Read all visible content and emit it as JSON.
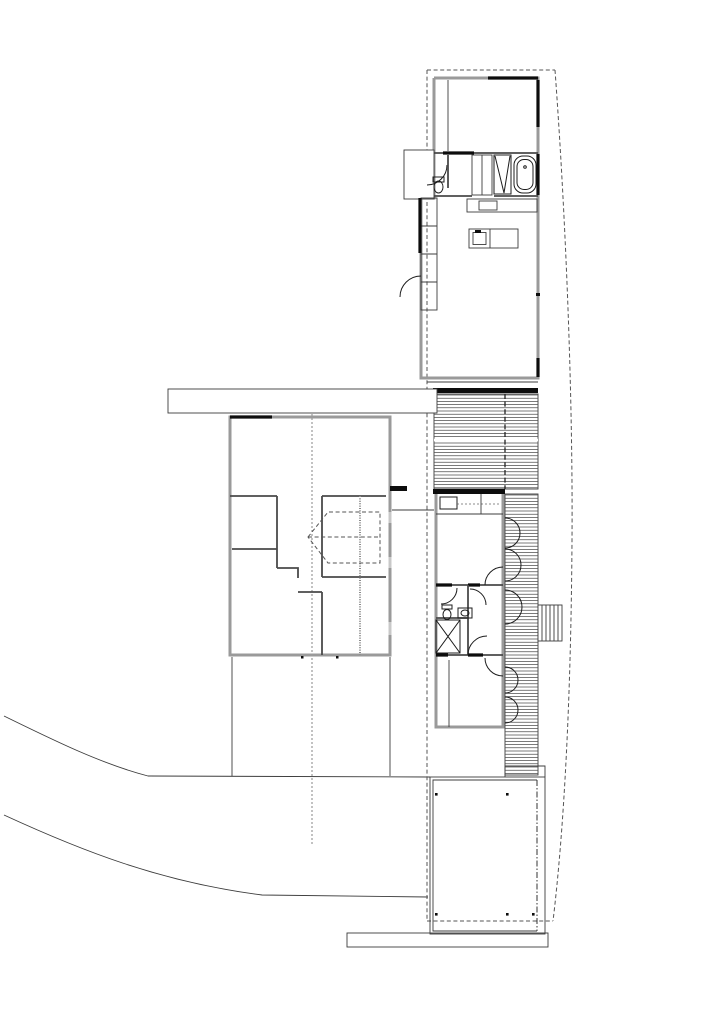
{
  "canvas": {
    "width": 724,
    "height": 1024,
    "viewBox": "0 0 724 1024",
    "background": "#ffffff"
  },
  "palette": {
    "ink": "#0d0d0d",
    "wall_gray": "#9a9a9a",
    "hatch_gray": "#4f4f4f",
    "dash_gray": "#555555",
    "background": "#ffffff"
  },
  "groups": [
    {
      "name": "site",
      "items": [
        {
          "tag": "path",
          "cls": "thin",
          "name": "ground-path-upper",
          "d": "M 4,716 C 55,741 102,764 148,776 L 430,777"
        },
        {
          "tag": "path",
          "cls": "thin",
          "name": "ground-path-lower",
          "d": "M 4,815 C 80,850 160,882 262,895 L 428,897"
        },
        {
          "tag": "line",
          "cls": "thin",
          "name": "courtyard-edge-west",
          "x1": 232,
          "y1": 657,
          "x2": 232,
          "y2": 776
        },
        {
          "tag": "line",
          "cls": "thin",
          "name": "courtyard-edge-east",
          "x1": 390,
          "y1": 657,
          "x2": 390,
          "y2": 776
        },
        {
          "tag": "line",
          "cls": "dashf",
          "name": "center-line",
          "x1": 312,
          "y1": 390,
          "x2": 312,
          "y2": 846
        }
      ]
    },
    {
      "name": "roof-outline",
      "items": [
        {
          "tag": "line",
          "cls": "dash",
          "name": "roof-edge-west",
          "x1": 427,
          "y1": 70,
          "x2": 427,
          "y2": 921
        },
        {
          "tag": "line",
          "cls": "dash",
          "name": "roof-edge-north",
          "x1": 427,
          "y1": 70,
          "x2": 555,
          "y2": 70
        },
        {
          "tag": "path",
          "cls": "dash",
          "name": "roof-edge-east-curved",
          "d": "M 555,70 C 566,220 573,400 572,540 C 571,700 564,830 553,921"
        },
        {
          "tag": "line",
          "cls": "dash",
          "name": "roof-edge-south",
          "x1": 427,
          "y1": 921,
          "x2": 553,
          "y2": 921
        }
      ]
    },
    {
      "name": "upper-pavilion",
      "items": [
        {
          "tag": "path",
          "cls": "wall",
          "name": "wall-outline-upper",
          "d": "M 434,78 L 538,78 L 538,378 L 421,378 L 421,198 L 434,198 L 434,78"
        },
        {
          "tag": "line",
          "cls": "wallD",
          "name": "wall-bedroom-bath",
          "x1": 434,
          "y1": 153,
          "x2": 538,
          "y2": 153
        },
        {
          "tag": "line",
          "cls": "solid",
          "name": "solid-wall-bedroom-bath",
          "x1": 443,
          "y1": 153,
          "x2": 474,
          "y2": 153
        },
        {
          "tag": "path",
          "cls": "wallD",
          "name": "wall-bath-south",
          "d": "M 434,196 L 472,196 M 494,196 L 538,196"
        },
        {
          "tag": "line",
          "cls": "solid",
          "name": "solid-wall-north",
          "x1": 488,
          "y1": 78,
          "x2": 538,
          "y2": 78
        },
        {
          "tag": "path",
          "cls": "solid",
          "name": "solid-wall-east",
          "d": "M 538,80 L 538,127 M 538,154 L 538,195 M 538,358 L 538,377"
        },
        {
          "tag": "line",
          "cls": "thin",
          "name": "bedroom-closet-divider",
          "x1": 448,
          "y1": 80,
          "x2": 448,
          "y2": 151
        },
        {
          "tag": "rect",
          "cls": "thinw",
          "name": "entry-porch",
          "x": 404,
          "y": 150,
          "w": 30,
          "h": 49
        },
        {
          "tag": "path",
          "cls": "fix",
          "name": "entry-door-arc",
          "d": "M 447,165 A 20 20 0 0 1 427,185"
        },
        {
          "tag": "line",
          "cls": "wallD",
          "name": "wc-wall",
          "x1": 448,
          "y1": 155,
          "x2": 448,
          "y2": 188
        },
        {
          "tag": "rect",
          "cls": "fix",
          "name": "toilet-tank-upper",
          "x": 433,
          "y": 177,
          "w": 11,
          "h": 5
        },
        {
          "tag": "ellipse",
          "cls": "fix",
          "name": "toilet-upper",
          "cx": 438.5,
          "cy": 187,
          "rx": 4.5,
          "ry": 6
        },
        {
          "tag": "rect",
          "cls": "thin",
          "name": "bath-closet",
          "x": 472,
          "y": 155,
          "w": 20,
          "h": 40
        },
        {
          "tag": "line",
          "cls": "thin",
          "name": "bath-closet-divider",
          "x1": 482,
          "y1": 155,
          "x2": 482,
          "y2": 195
        },
        {
          "tag": "rect",
          "cls": "fix",
          "name": "shower-upper",
          "x": 494,
          "y": 155,
          "w": 17,
          "h": 39
        },
        {
          "tag": "path",
          "cls": "fix",
          "name": "shower-upper-glass",
          "d": "M 495,156 L 504,193 L 510,156"
        },
        {
          "tag": "rect",
          "cls": "fix",
          "name": "bathtub-outer",
          "x": 514,
          "y": 156,
          "w": 22,
          "h": 37,
          "rx": 9
        },
        {
          "tag": "rect",
          "cls": "fix",
          "name": "bathtub-inner",
          "x": 517,
          "y": 159.5,
          "w": 16,
          "h": 30,
          "rx": 7
        },
        {
          "tag": "circle",
          "cls": "fix",
          "name": "bathtub-drain",
          "cx": 525,
          "cy": 167,
          "r": 1.3
        },
        {
          "tag": "rect",
          "cls": "thin",
          "name": "kitchen-counter",
          "x": 467,
          "y": 199,
          "w": 70,
          "h": 13
        },
        {
          "tag": "rect",
          "cls": "thin",
          "name": "counter-sink",
          "x": 479,
          "y": 201,
          "w": 18,
          "h": 9
        },
        {
          "tag": "rect",
          "cls": "thin",
          "name": "west-closet",
          "x": 421,
          "y": 198,
          "w": 16,
          "h": 112
        },
        {
          "tag": "path",
          "cls": "thin",
          "name": "west-closet-dividers",
          "d": "M 421,226 L 437,226 M 421,254 L 437,254 M 421,282 L 437,282"
        },
        {
          "tag": "line",
          "cls": "solid",
          "name": "solid-wall-west",
          "x1": 420,
          "y1": 198,
          "x2": 420,
          "y2": 253
        },
        {
          "tag": "path",
          "cls": "fix",
          "name": "west-door-arc",
          "d": "M 400,297 A 21 21 0 0 1 421,276"
        },
        {
          "tag": "rect",
          "cls": "thin",
          "name": "kitchen-island",
          "x": 469,
          "y": 229,
          "w": 49,
          "h": 19
        },
        {
          "tag": "rect",
          "cls": "thin",
          "name": "island-sink",
          "x": 473,
          "y": 232.5,
          "w": 13,
          "h": 12
        },
        {
          "tag": "rect",
          "cls": "fill",
          "name": "island-faucet",
          "x": 475,
          "y": 230,
          "w": 6,
          "h": 3
        },
        {
          "tag": "line",
          "cls": "thin",
          "name": "island-divider",
          "x1": 490,
          "y1": 229,
          "x2": 490,
          "y2": 248
        },
        {
          "tag": "line",
          "cls": "thin",
          "name": "south-step-edge",
          "x1": 427,
          "y1": 382,
          "x2": 538,
          "y2": 382
        },
        {
          "tag": "rect",
          "cls": "fill",
          "name": "threshold-bar",
          "x": 433,
          "y": 388,
          "w": 105,
          "h": 5
        },
        {
          "tag": "rect",
          "cls": "fill",
          "name": "window-tick-east",
          "x": 536,
          "y": 293,
          "w": 4,
          "h": 3
        }
      ]
    },
    {
      "name": "deck",
      "items": [
        {
          "tag": "rect",
          "cls": "thin",
          "name": "deck-upper-outline",
          "x": 434,
          "y": 394,
          "w": 104,
          "h": 95
        },
        {
          "tag": "hatch",
          "cls": "hatch",
          "name": "deck-upper-boards",
          "x": 434,
          "y": 394,
          "w": 104,
          "h": 95,
          "step": 3.2
        },
        {
          "tag": "line",
          "cls": "gap",
          "name": "deck-joint",
          "x1": 434,
          "y1": 440,
          "x2": 538,
          "y2": 440
        },
        {
          "tag": "line",
          "cls": "dashw",
          "name": "deck-axis-line",
          "x1": 505,
          "y1": 394,
          "x2": 505,
          "y2": 489
        },
        {
          "tag": "rect",
          "cls": "thin",
          "name": "deck-side-outline",
          "x": 505,
          "y": 494,
          "w": 33,
          "h": 281
        },
        {
          "tag": "hatch",
          "cls": "hatch",
          "name": "deck-side-boards",
          "x": 505,
          "y": 494,
          "w": 33,
          "h": 281,
          "step": 3.2
        },
        {
          "tag": "rect",
          "cls": "thinw",
          "name": "deck-stairs",
          "x": 538,
          "y": 605,
          "w": 24,
          "h": 36
        },
        {
          "tag": "path",
          "cls": "thin",
          "name": "stair-treads",
          "d": "M 542,605 L 542,641 M 546,605 L 546,641 M 550,605 L 550,641 M 554,605 L 554,641 M 558,605 L 558,641"
        },
        {
          "tag": "path",
          "cls": "fix",
          "name": "deck-door-arc-1",
          "d": "M 505,518 A 15 15 0 0 1 505,548"
        },
        {
          "tag": "path",
          "cls": "fix",
          "name": "deck-door-arc-2",
          "d": "M 505,549 A 16 16 0 0 1 505,581"
        },
        {
          "tag": "path",
          "cls": "fix",
          "name": "deck-door-arc-3",
          "d": "M 505,590 A 17 17 0 0 1 505,624"
        },
        {
          "tag": "path",
          "cls": "fix",
          "name": "deck-door-arc-4",
          "d": "M 505,667 A 13 13 0 0 1 505,693"
        },
        {
          "tag": "path",
          "cls": "fix",
          "name": "deck-door-arc-5",
          "d": "M 505,697 A 13 13 0 0 1 505,723"
        }
      ]
    },
    {
      "name": "middle-pavilion",
      "items": [
        {
          "tag": "rect",
          "cls": "wall",
          "name": "wall-outline-middle",
          "x": 436,
          "y": 492,
          "w": 67,
          "h": 235
        },
        {
          "tag": "rect",
          "cls": "fill",
          "name": "threshold-middle",
          "x": 433,
          "y": 489,
          "w": 72,
          "h": 5
        },
        {
          "tag": "line",
          "cls": "thin",
          "name": "kitchenette-counter",
          "x1": 436,
          "y1": 514,
          "x2": 503,
          "y2": 514
        },
        {
          "tag": "rect",
          "cls": "fix",
          "name": "kitchenette-appliance",
          "x": 440,
          "y": 497,
          "w": 17,
          "h": 12
        },
        {
          "tag": "line",
          "cls": "dashf",
          "name": "kitchenette-dash",
          "x1": 457,
          "y1": 504,
          "x2": 500,
          "y2": 504
        },
        {
          "tag": "line",
          "cls": "thin",
          "name": "kitchenette-divider",
          "x1": 481,
          "y1": 494,
          "x2": 481,
          "y2": 514
        },
        {
          "tag": "line",
          "cls": "wallD",
          "name": "wall-bed1-south",
          "x1": 436,
          "y1": 585,
          "x2": 503,
          "y2": 585
        },
        {
          "tag": "path",
          "cls": "solid",
          "name": "solid-bed1-south",
          "d": "M 436,585 L 452,585 M 468,585 L 480,585"
        },
        {
          "tag": "path",
          "cls": "fix",
          "name": "bed1-door-arc",
          "d": "M 485,585 A 18 18 0 0 1 503,567"
        },
        {
          "tag": "line",
          "cls": "wallD",
          "name": "hall-wall-west",
          "x1": 468,
          "y1": 585,
          "x2": 468,
          "y2": 655
        },
        {
          "tag": "line",
          "cls": "wallD",
          "name": "wc2-wall-south",
          "x1": 436,
          "y1": 618,
          "x2": 468,
          "y2": 618
        },
        {
          "tag": "line",
          "cls": "wallD",
          "name": "wall-bed2-north",
          "x1": 436,
          "y1": 655,
          "x2": 503,
          "y2": 655
        },
        {
          "tag": "path",
          "cls": "solid",
          "name": "solid-bed2-north",
          "d": "M 436,655 L 448,655 M 468,655 L 483,655"
        },
        {
          "tag": "path",
          "cls": "fix",
          "name": "wc2-door-arc",
          "d": "M 457,588 A 16 16 0 0 1 441,604"
        },
        {
          "tag": "rect",
          "cls": "fix",
          "name": "toilet-tank-mid",
          "x": 442,
          "y": 605,
          "w": 10,
          "h": 4
        },
        {
          "tag": "ellipse",
          "cls": "fix",
          "name": "toilet-mid",
          "cx": 447,
          "cy": 614.5,
          "rx": 4,
          "ry": 5
        },
        {
          "tag": "rect",
          "cls": "fix",
          "name": "sink-mid",
          "x": 458,
          "y": 608,
          "w": 14,
          "h": 10
        },
        {
          "tag": "ellipse",
          "cls": "fix",
          "name": "sink-basin-mid",
          "cx": 465,
          "cy": 613,
          "rx": 4,
          "ry": 3
        },
        {
          "tag": "rect",
          "cls": "fix",
          "name": "shower-mid",
          "x": 436,
          "y": 620,
          "w": 24,
          "h": 33
        },
        {
          "tag": "path",
          "cls": "fix",
          "name": "shower-mid-x",
          "d": "M 436,620 L 460,653 M 460,620 L 436,653"
        },
        {
          "tag": "path",
          "cls": "fix",
          "name": "hall-door-arc-a",
          "d": "M 470,589 A 16 16 0 0 1 486,605"
        },
        {
          "tag": "path",
          "cls": "fix",
          "name": "hall-door-arc-b",
          "d": "M 468,655 A 19 19 0 0 1 487,636"
        },
        {
          "tag": "path",
          "cls": "fix",
          "name": "bed2-door-arc",
          "d": "M 503,676 A 18 18 0 0 1 485,658"
        },
        {
          "tag": "line",
          "cls": "thin",
          "name": "bed2-closet-divider",
          "x1": 449,
          "y1": 660,
          "x2": 449,
          "y2": 727
        },
        {
          "tag": "line",
          "cls": "thin",
          "name": "link-line",
          "x1": 392,
          "y1": 510,
          "x2": 434,
          "y2": 510
        }
      ]
    },
    {
      "name": "left-wing",
      "items": [
        {
          "tag": "rect",
          "cls": "thinw",
          "name": "walkway-band",
          "x": 168,
          "y": 389,
          "w": 269,
          "h": 24
        },
        {
          "tag": "rect",
          "cls": "wall",
          "name": "wall-outline-left",
          "x": 230,
          "y": 417,
          "w": 160,
          "h": 238
        },
        {
          "tag": "line",
          "cls": "solid",
          "name": "solid-left-north",
          "x1": 230,
          "y1": 417,
          "x2": 272,
          "y2": 417
        },
        {
          "tag": "path",
          "cls": "wallD",
          "name": "interior-walls-left",
          "d": "M 230,496 L 277,496 M 277,496 L 277,568 M 232,549 L 277,549 M 277,568 L 298,568 L 298,578 M 298,592 L 322,592 M 322,592 L 322,655 M 322,496 L 322,577 M 322,577 L 386,577 M 322,496 L 386,496"
        },
        {
          "tag": "line",
          "cls": "wallDot",
          "name": "stud-wall",
          "x1": 360,
          "y1": 496,
          "x2": 360,
          "y2": 655
        },
        {
          "tag": "path",
          "cls": "dash",
          "name": "attic-outline",
          "d": "M 308,537 L 328,512 L 380,512 L 380,563 L 328,563 Z"
        },
        {
          "tag": "line",
          "cls": "dash",
          "name": "attic-center-line",
          "x1": 308,
          "y1": 537,
          "x2": 380,
          "y2": 537
        },
        {
          "tag": "rect",
          "cls": "fill",
          "name": "wall-flag",
          "x": 390,
          "y": 486,
          "w": 17,
          "h": 5
        },
        {
          "tag": "path",
          "cls": "win",
          "name": "window-segments-east",
          "d": "M 390,512 L 390,523 M 390,557 L 390,568 M 390,622 L 390,635"
        },
        {
          "tag": "rect",
          "cls": "fill",
          "name": "survey-dot-a",
          "x": 301,
          "y": 656,
          "w": 2.5,
          "h": 2.5
        },
        {
          "tag": "rect",
          "cls": "fill",
          "name": "survey-dot-b",
          "x": 336,
          "y": 656,
          "w": 2.5,
          "h": 2.5
        }
      ]
    },
    {
      "name": "lower-terrace",
      "items": [
        {
          "tag": "rect",
          "cls": "thin",
          "name": "terrace-outer",
          "x": 430,
          "y": 777,
          "w": 115,
          "h": 157
        },
        {
          "tag": "path",
          "cls": "thin",
          "name": "terrace-notch",
          "d": "M 505,777 L 505,766 L 545,766 L 545,777"
        },
        {
          "tag": "path",
          "cls": "thin",
          "name": "terrace-inner",
          "d": "M 537,780 L 433,780 L 433,931 L 537,931"
        },
        {
          "tag": "line",
          "cls": "dashdot",
          "name": "terrace-inner-east",
          "x1": 537,
          "y1": 780,
          "x2": 537,
          "y2": 931
        },
        {
          "tag": "rect",
          "cls": "fill",
          "name": "post-nw",
          "x": 435,
          "y": 793,
          "w": 2.6,
          "h": 2.6
        },
        {
          "tag": "rect",
          "cls": "fill",
          "name": "post-ne",
          "x": 506,
          "y": 793,
          "w": 2.6,
          "h": 2.6
        },
        {
          "tag": "rect",
          "cls": "fill",
          "name": "post-sw",
          "x": 435,
          "y": 913,
          "w": 2.6,
          "h": 2.6
        },
        {
          "tag": "rect",
          "cls": "fill",
          "name": "post-s",
          "x": 506,
          "y": 913,
          "w": 2.6,
          "h": 2.6
        },
        {
          "tag": "rect",
          "cls": "fill",
          "name": "post-se",
          "x": 532,
          "y": 913,
          "w": 2.6,
          "h": 2.6
        },
        {
          "tag": "rect",
          "cls": "thin",
          "name": "terrace-step",
          "x": 347,
          "y": 933,
          "w": 201,
          "h": 14
        }
      ]
    }
  ]
}
